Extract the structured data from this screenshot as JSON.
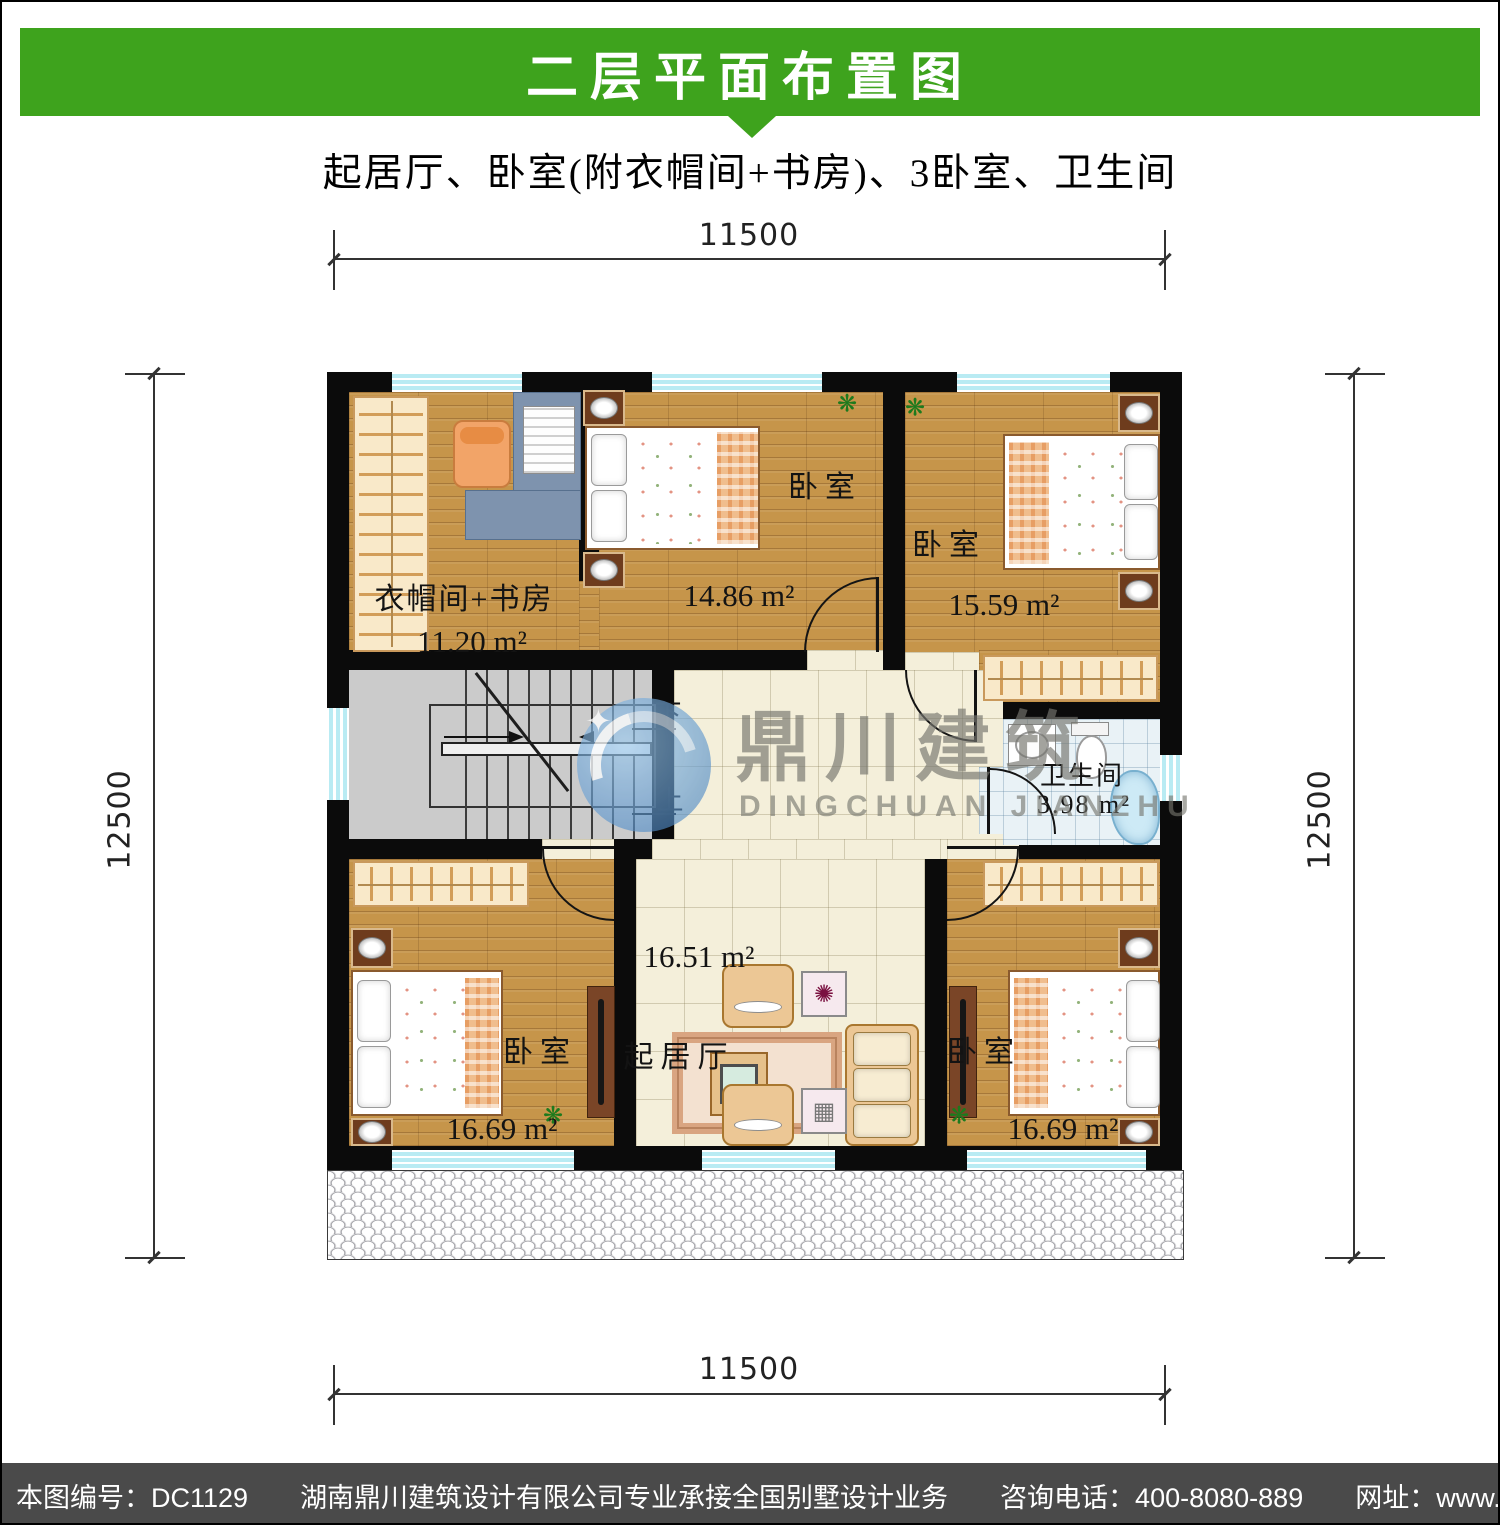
{
  "header": {
    "title": "二层平面布置图",
    "subtitle": "起居厅、卧室(附衣帽间+书房)、3卧室、卫生间"
  },
  "colors": {
    "header_green": "#3ea31d",
    "footer_gray": "#4a4a4a",
    "watermark_blue": "#4a88c0",
    "wall_black": "#0b0b0b"
  },
  "dimensions": {
    "top": "11500",
    "bottom": "11500",
    "left": "12500",
    "right": "12500"
  },
  "rooms": {
    "cloakroom": {
      "name": "衣帽间+书房",
      "area": "11.20 m²"
    },
    "bedroom_top_middle": {
      "name": "卧室",
      "area": "14.86 m²"
    },
    "bedroom_top_right": {
      "name": "卧室",
      "area": "15.59 m²"
    },
    "bathroom": {
      "name": "卫生间",
      "area": "3.98 m²"
    },
    "hallway": {
      "area": "16.51 m²"
    },
    "living_room": {
      "name": "起居厅"
    },
    "bedroom_bottom_left": {
      "name": "卧室",
      "area": "16.69 m²"
    },
    "bedroom_bottom_right": {
      "name": "卧室",
      "area": "16.69 m²"
    }
  },
  "stairs": {
    "down_label": "下",
    "up_label": "上"
  },
  "watermark": {
    "cn": "鼎川建筑",
    "en": "DINGCHUAN JIANZHU"
  },
  "footer": {
    "drawing_no": "本图编号：DC1129",
    "company": "湖南鼎川建筑设计有限公司专业承接全国别墅设计业务",
    "phone": "咨询电话：400-8080-889",
    "website": "网址：www.bstzcs.com"
  }
}
